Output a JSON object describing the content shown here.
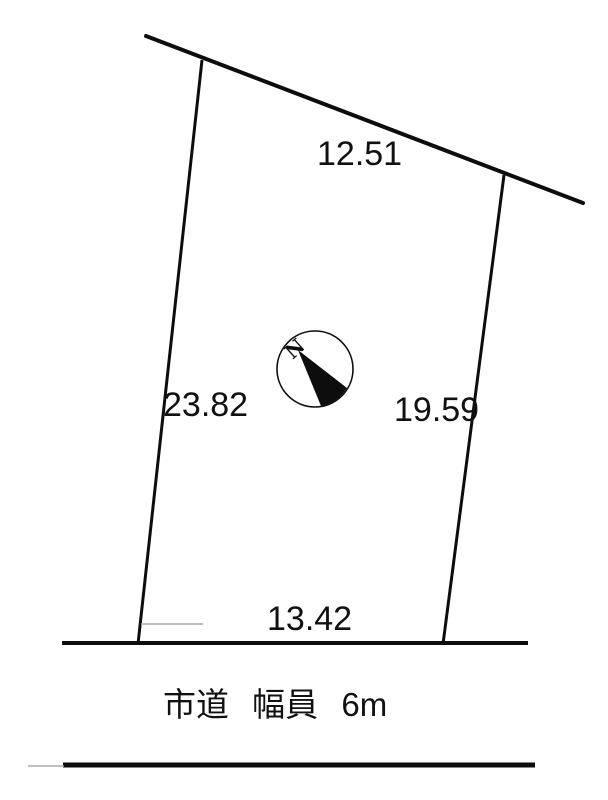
{
  "page": {
    "background": "#ffffff",
    "ink": "#0d0d0d",
    "faint_line_color": "#aaaaaa"
  },
  "plot": {
    "type": "land-parcel-survey-diagram",
    "dimensions": {
      "top": "12.51",
      "left": "23.82",
      "right": "19.59",
      "bottom": "13.42"
    }
  },
  "compass": {
    "north_label": "N"
  },
  "road": {
    "label": "市道 幅員 6m"
  }
}
